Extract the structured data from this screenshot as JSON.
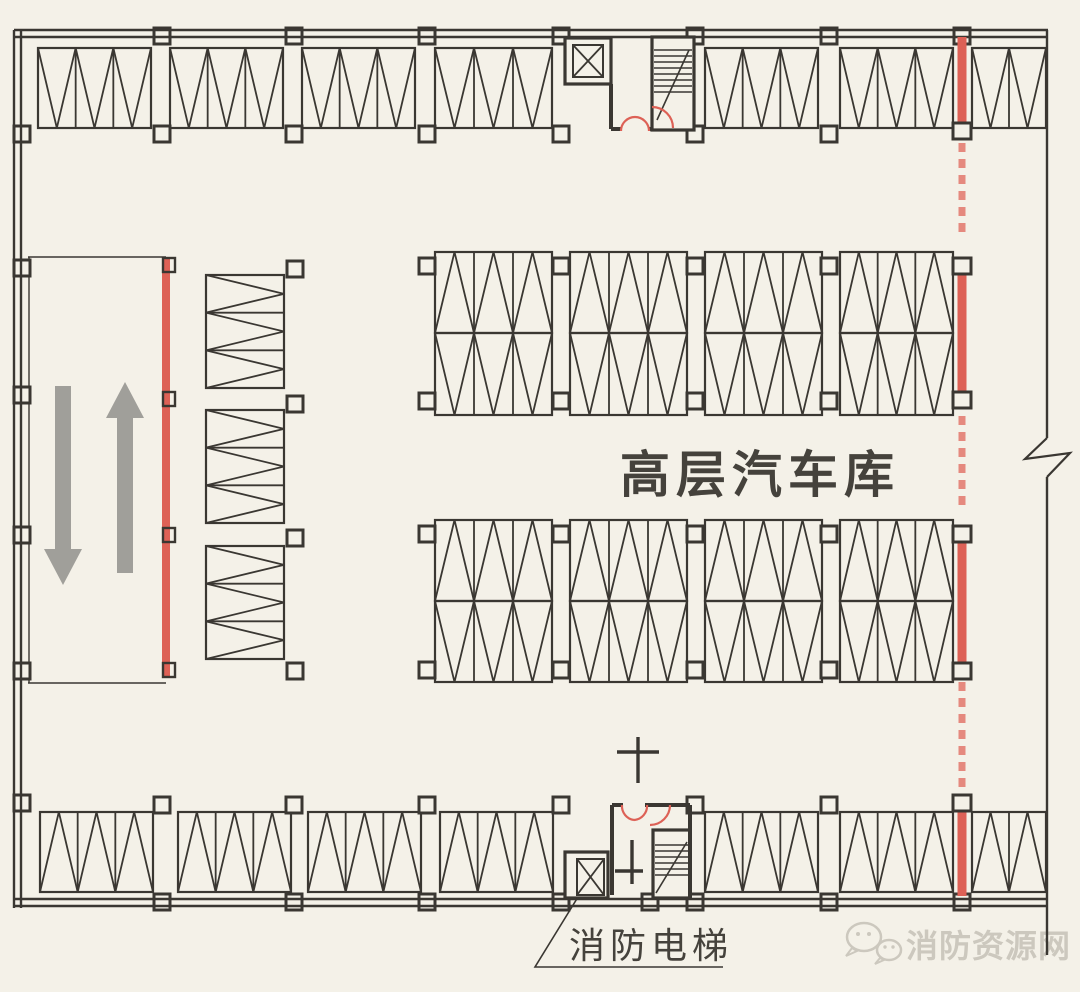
{
  "labels": {
    "garage_area": "高层汽车库",
    "fire_elevator": "消防电梯"
  },
  "watermark": {
    "text": "消防资源网",
    "icon": "wechat-chat-bubbles-icon"
  },
  "colors": {
    "paper": "#f4f1e8",
    "line": "#3a3732",
    "ink": "#45423c",
    "red": "#dd6156",
    "red_dash": "#e5897e",
    "arrow": "#a09f9a",
    "watermark": "#ccc8be"
  },
  "plan": {
    "walls": {
      "segments": [
        [
          14,
          30,
          14,
          908
        ],
        [
          21,
          30,
          21,
          908
        ],
        [
          14,
          30,
          1048,
          30
        ],
        [
          14,
          37,
          1048,
          37
        ],
        [
          14,
          899,
          1048,
          899
        ],
        [
          14,
          906,
          1048,
          906
        ],
        [
          1047,
          30,
          1047,
          438
        ],
        [
          1047,
          477,
          1047,
          955
        ]
      ],
      "break_path": "M1047,438 L1025,459 L1070,453 L1047,477"
    },
    "stall_rows": [
      {
        "name": "top-row",
        "orient": "h",
        "y": 48,
        "h": 80,
        "apex": "down",
        "groups": [
          [
            38,
            151,
            3
          ],
          [
            170,
            283,
            3
          ],
          [
            302,
            415,
            3
          ],
          [
            435,
            552,
            3
          ],
          [
            705,
            818,
            3
          ],
          [
            840,
            953,
            3
          ],
          [
            972,
            1046,
            2
          ]
        ]
      },
      {
        "name": "bottom-row",
        "orient": "h",
        "y": 812,
        "h": 80,
        "apex": "up",
        "groups": [
          [
            40,
            153,
            3
          ],
          [
            178,
            291,
            3
          ],
          [
            308,
            421,
            3
          ],
          [
            440,
            553,
            3
          ],
          [
            705,
            818,
            3
          ],
          [
            840,
            953,
            3
          ],
          [
            972,
            1046,
            2
          ]
        ]
      },
      {
        "name": "mid-upper-a",
        "orient": "h",
        "y": 252,
        "h": 81,
        "apex": "up",
        "groups": [
          [
            435,
            552,
            3
          ],
          [
            570,
            687,
            3
          ],
          [
            705,
            822,
            3
          ],
          [
            840,
            953,
            3
          ]
        ]
      },
      {
        "name": "mid-upper-b",
        "orient": "h",
        "y": 333,
        "h": 82,
        "apex": "down",
        "groups": [
          [
            435,
            552,
            3
          ],
          [
            570,
            687,
            3
          ],
          [
            705,
            822,
            3
          ],
          [
            840,
            953,
            3
          ]
        ]
      },
      {
        "name": "mid-lower-a",
        "orient": "h",
        "y": 520,
        "h": 81,
        "apex": "up",
        "groups": [
          [
            435,
            552,
            3
          ],
          [
            570,
            687,
            3
          ],
          [
            705,
            822,
            3
          ],
          [
            840,
            953,
            3
          ]
        ]
      },
      {
        "name": "mid-lower-b",
        "orient": "h",
        "y": 601,
        "h": 81,
        "apex": "down",
        "groups": [
          [
            435,
            552,
            3
          ],
          [
            570,
            687,
            3
          ],
          [
            705,
            822,
            3
          ],
          [
            840,
            953,
            3
          ]
        ]
      },
      {
        "name": "left-column",
        "orient": "v",
        "x": 206,
        "w": 78,
        "apex": "right",
        "groups": [
          [
            275,
            388,
            3
          ],
          [
            410,
            523,
            3
          ],
          [
            546,
            659,
            3
          ]
        ]
      }
    ],
    "columns": {
      "size": 16,
      "items": [
        [
          162,
          36
        ],
        [
          294,
          36
        ],
        [
          427,
          36
        ],
        [
          561,
          36
        ],
        [
          695,
          36
        ],
        [
          829,
          36
        ],
        [
          962,
          36
        ],
        [
          162,
          902
        ],
        [
          294,
          902
        ],
        [
          427,
          902
        ],
        [
          561,
          902
        ],
        [
          650,
          902
        ],
        [
          695,
          902
        ],
        [
          829,
          902
        ],
        [
          962,
          902
        ],
        [
          22,
          134
        ],
        [
          22,
          268
        ],
        [
          22,
          395
        ],
        [
          22,
          535
        ],
        [
          22,
          671
        ],
        [
          22,
          803
        ],
        [
          162,
          134
        ],
        [
          294,
          134
        ],
        [
          427,
          134
        ],
        [
          561,
          134
        ],
        [
          695,
          134
        ],
        [
          829,
          134
        ],
        [
          162,
          805
        ],
        [
          294,
          805
        ],
        [
          427,
          805
        ],
        [
          561,
          805
        ],
        [
          695,
          805
        ],
        [
          829,
          805
        ],
        [
          427,
          266
        ],
        [
          561,
          266
        ],
        [
          695,
          266
        ],
        [
          829,
          266
        ],
        [
          427,
          401
        ],
        [
          561,
          401
        ],
        [
          695,
          401
        ],
        [
          829,
          401
        ],
        [
          427,
          534
        ],
        [
          561,
          534
        ],
        [
          695,
          534
        ],
        [
          829,
          534
        ],
        [
          427,
          670
        ],
        [
          561,
          670
        ],
        [
          695,
          670
        ],
        [
          829,
          670
        ],
        [
          295,
          269
        ],
        [
          295,
          404
        ],
        [
          295,
          538
        ],
        [
          295,
          671
        ]
      ]
    },
    "ramp": {
      "outline": [
        [
          28,
          257,
          166,
          257
        ],
        [
          28,
          683,
          166,
          683
        ],
        [
          29,
          257,
          29,
          683
        ]
      ],
      "red_line": [
        166,
        258,
        166,
        678
      ],
      "brackets_y": [
        265,
        399,
        535,
        670
      ],
      "arrows": [
        {
          "dir": "down",
          "cx": 63,
          "y0": 386,
          "y1": 585
        },
        {
          "dir": "up",
          "cx": 125,
          "y0": 382,
          "y1": 573
        }
      ]
    },
    "red_divider": {
      "x": 962,
      "solid": [
        [
          37,
          123
        ],
        [
          274,
          392
        ],
        [
          542,
          663
        ],
        [
          811,
          896
        ]
      ],
      "dashed": [
        [
          143,
          238
        ],
        [
          416,
          512
        ],
        [
          682,
          792
        ]
      ],
      "brackets_y": [
        131,
        266,
        400,
        534,
        671,
        803
      ]
    },
    "cores": {
      "walls": [
        [
          611,
          84,
          611,
          129
        ],
        [
          611,
          129,
          622,
          129
        ],
        [
          648,
          129,
          652,
          129
        ],
        [
          612,
          805,
          612,
          895
        ],
        [
          612,
          805,
          623,
          805
        ],
        [
          645,
          805,
          690,
          805
        ],
        [
          690,
          805,
          690,
          898
        ]
      ],
      "boxes": [
        [
          565,
          38,
          46,
          46
        ],
        [
          652,
          37,
          42,
          93
        ],
        [
          565,
          852,
          43,
          46
        ],
        [
          653,
          830,
          37,
          68
        ]
      ],
      "elevator_cars": [
        [
          573,
          45,
          30,
          32
        ],
        [
          577,
          859,
          27,
          36
        ]
      ],
      "stairs": [
        {
          "x0": 654,
          "x1": 692,
          "y0": 50,
          "dy": 6,
          "n": 8,
          "diag": [
            657,
            120,
            689,
            50
          ]
        },
        {
          "x0": 655,
          "x1": 688,
          "y0": 845,
          "dy": 6,
          "n": 6,
          "diag": [
            656,
            893,
            687,
            842
          ]
        }
      ],
      "crosses": [
        {
          "v": [
            638,
            737,
            638,
            783
          ],
          "h": [
            617,
            752,
            659,
            752
          ]
        },
        {
          "v": [
            632,
            840,
            632,
            884
          ],
          "h": [
            615,
            871,
            643,
            871
          ]
        }
      ],
      "red_doors": [
        "M621,131 A14,14 0 0 1 635,117",
        "M649,131 A14,14 0 0 0 635,117",
        "M652,107 A21,21 0 0 1 673,128",
        "M622,805 A14,14 0 0 0 634,820",
        "M647,805 A14,14 0 0 1 634,820",
        "M670,805 A20,20 0 0 1 650,825"
      ]
    },
    "leader": {
      "points": [
        [
          578,
          897
        ],
        [
          535,
          967
        ],
        [
          723,
          967
        ]
      ]
    }
  }
}
